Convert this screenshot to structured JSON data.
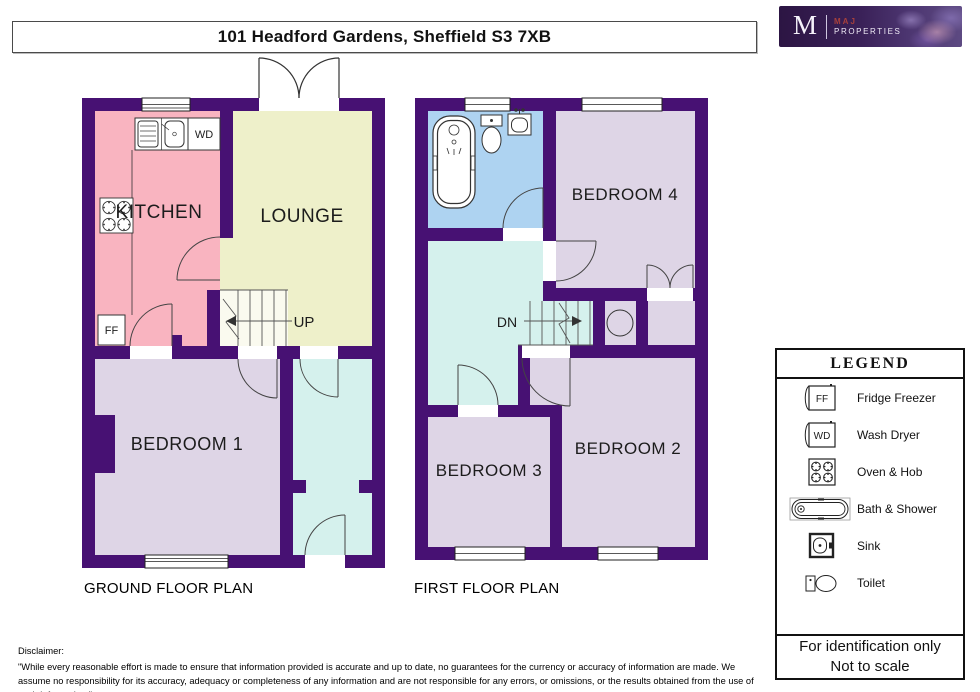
{
  "header": {
    "title": "101 Headford Gardens, Sheffield S3 7XB"
  },
  "logo": {
    "monogram": "M",
    "name_top": "MAJ",
    "name_bottom": "PROPERTIES"
  },
  "plans": {
    "ground": {
      "label": "GROUND FLOOR PLAN",
      "rooms": {
        "kitchen": "KITCHEN",
        "lounge": "LOUNGE",
        "bedroom1": "BEDROOM 1"
      },
      "stairs_direction": "UP",
      "appliances": {
        "wash_dryer": "WD",
        "fridge_freezer": "FF"
      }
    },
    "first": {
      "label": "FIRST FLOOR PLAN",
      "rooms": {
        "bedroom4": "BEDROOM 4",
        "bedroom3": "BEDROOM 3",
        "bedroom2": "BEDROOM 2"
      },
      "stairs_direction": "DN"
    }
  },
  "legend": {
    "title": "LEGEND",
    "items": [
      {
        "icon": "fridge-freezer-icon",
        "abbr": "FF",
        "label": "Fridge Freezer"
      },
      {
        "icon": "wash-dryer-icon",
        "abbr": "WD",
        "label": "Wash Dryer"
      },
      {
        "icon": "oven-hob-icon",
        "label": "Oven & Hob"
      },
      {
        "icon": "bath-shower-icon",
        "label": "Bath & Shower"
      },
      {
        "icon": "sink-icon",
        "label": "Sink"
      },
      {
        "icon": "toilet-icon",
        "label": "Toilet"
      }
    ],
    "note_line1": "For identification only",
    "note_line2": "Not to scale"
  },
  "disclaimer": {
    "heading": "Disclaimer:",
    "text": "\"While every reasonable effort is made to ensure that information provided is accurate and up to date, no guarantees for the currency or accuracy of information are made. We assume no responsibility for its accuracy, adequacy or completeness of any information and are not responsible for any errors, or omissions, or the results obtained from the use of such information.\""
  },
  "colors": {
    "wall": "#471173",
    "kitchen": "#f9b4c0",
    "lounge": "#eef0ca",
    "bedroom": "#ded5e6",
    "hallway": "#d5f1ed",
    "bathroom": "#aed3f1"
  }
}
